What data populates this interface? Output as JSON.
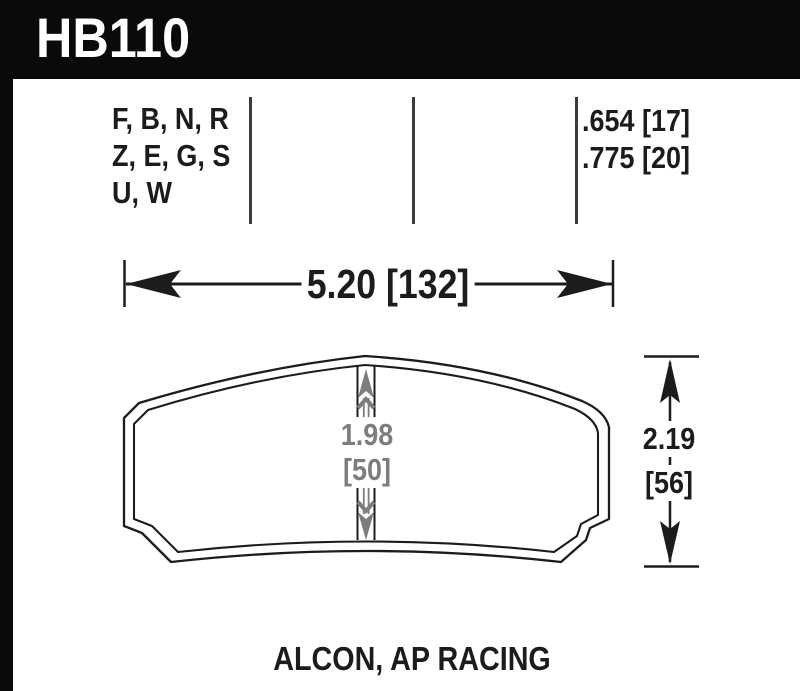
{
  "header": {
    "part_number": "HB110"
  },
  "spec_table": {
    "compound_codes": [
      "F, B, N, R",
      "Z, E, G, S",
      "U, W"
    ],
    "thickness_options": [
      ".654 [17]",
      ".775 [20]"
    ]
  },
  "dimensions": {
    "overall_width": "5.20 [132]",
    "pad_height_in": "1.98",
    "pad_height_mm": "[50]",
    "overall_height_in": "2.19",
    "overall_height_mm": "[56]"
  },
  "footer": {
    "applications": "ALCON, AP RACING"
  },
  "colors": {
    "ink": "#1c1c1c",
    "dim_gray": "#7d7d7d",
    "header_bg": "#0a0a0a"
  }
}
